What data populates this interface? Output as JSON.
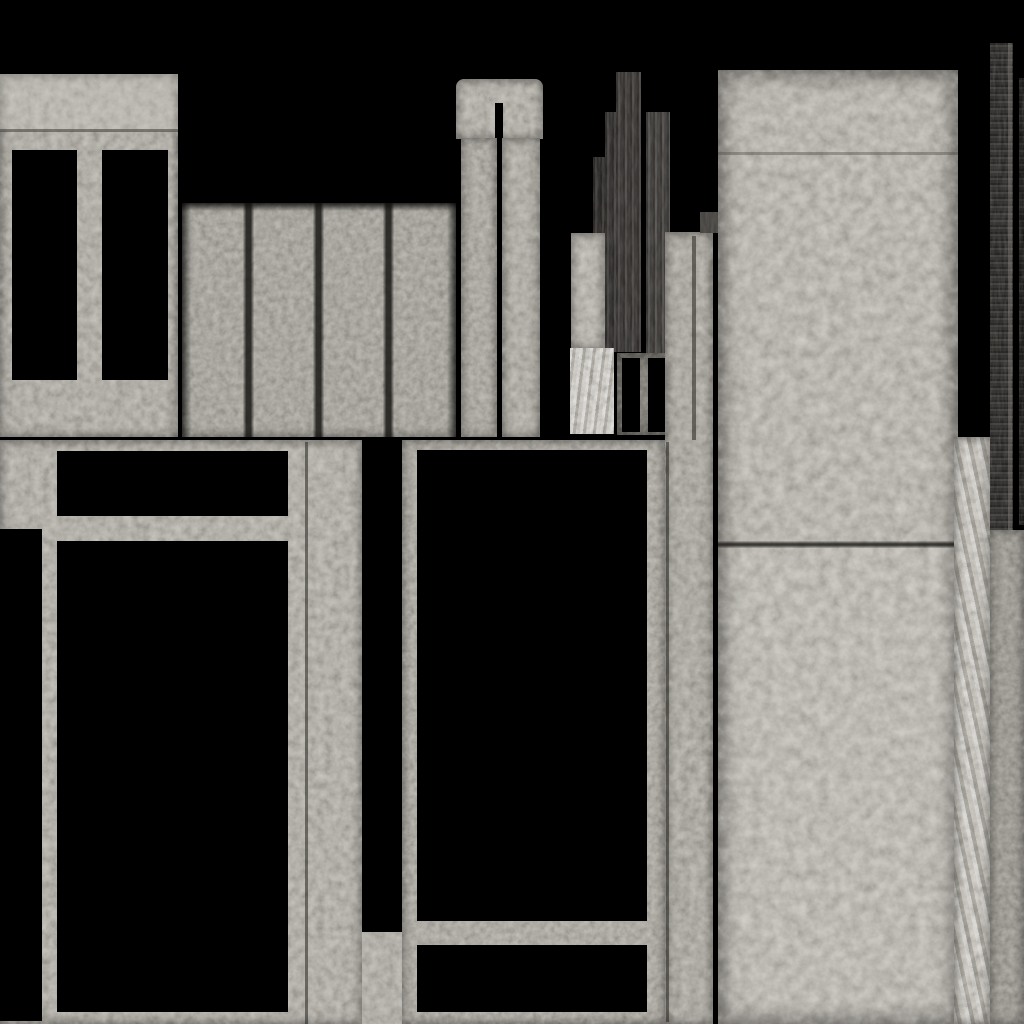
{
  "canvas": {
    "width": 1024,
    "height": 1024,
    "background": "#000000"
  },
  "palette": {
    "background": "#000000",
    "concrete_light": "#c1beb7",
    "concrete_mid": "#b5b2ab",
    "concrete_dark": "#8d8a83",
    "metal_dark": "#3e3c3a",
    "silver_streak": "#c5c2bb"
  },
  "shapes": [
    {
      "name": "top-left-panel",
      "cls": "concrete edge-soft",
      "x": 0,
      "y": 74,
      "w": 178,
      "h": 363,
      "fill": "#b9b6af"
    },
    {
      "name": "top-left-panel-upper-band",
      "cls": "plain",
      "x": 0,
      "y": 74,
      "w": 178,
      "h": 57,
      "fill": "rgba(210,207,200,0.30)"
    },
    {
      "name": "top-left-panel-seam",
      "cls": "plain",
      "x": 0,
      "y": 129,
      "w": 178,
      "h": 3,
      "fill": "rgba(60,58,53,0.55)"
    },
    {
      "name": "window-hole-a",
      "cls": "hole",
      "x": 12,
      "y": 150,
      "w": 65,
      "h": 230
    },
    {
      "name": "window-hole-b",
      "cls": "hole",
      "x": 102,
      "y": 150,
      "w": 66,
      "h": 230
    },
    {
      "name": "ribbed-panel",
      "cls": "concrete2 edge-soft",
      "x": 182,
      "y": 203,
      "w": 274,
      "h": 234,
      "fill": "#b2afa8"
    },
    {
      "name": "ribbed-panel-top-shadow",
      "cls": "fade-down",
      "x": 182,
      "y": 203,
      "w": 274,
      "h": 8
    },
    {
      "name": "rib-groove-1",
      "cls": "groove-v",
      "x": 243,
      "y": 203,
      "w": 11,
      "h": 234
    },
    {
      "name": "rib-groove-2",
      "cls": "groove-v",
      "x": 313,
      "y": 203,
      "w": 11,
      "h": 234
    },
    {
      "name": "rib-groove-3",
      "cls": "groove-v",
      "x": 383,
      "y": 203,
      "w": 11,
      "h": 234
    },
    {
      "name": "rib-edge-left",
      "cls": "fade-right",
      "x": 182,
      "y": 203,
      "w": 9,
      "h": 234
    },
    {
      "name": "rib-edge-right",
      "cls": "fade-left",
      "x": 447,
      "y": 203,
      "w": 9,
      "h": 234
    },
    {
      "name": "pillar-cap",
      "cls": "concrete edge-soft",
      "x": 456,
      "y": 79,
      "w": 87,
      "h": 60,
      "fill": "#bdbab3",
      "radius": "8px 8px 0 0"
    },
    {
      "name": "pillar-cap-notch",
      "cls": "hole",
      "x": 495,
      "y": 103,
      "w": 8,
      "h": 36
    },
    {
      "name": "pillar-leg-left",
      "cls": "concrete2 edge-soft",
      "x": 461,
      "y": 138,
      "w": 36,
      "h": 299,
      "fill": "#b7b4ad"
    },
    {
      "name": "pillar-leg-right",
      "cls": "concrete edge-soft",
      "x": 502,
      "y": 138,
      "w": 38,
      "h": 299,
      "fill": "#bab7b0"
    },
    {
      "name": "dark-bar-1",
      "cls": "metal streak-v",
      "x": 593,
      "y": 157,
      "w": 12,
      "h": 193,
      "fill": "#3b3936"
    },
    {
      "name": "dark-bar-2",
      "cls": "metal streak-v",
      "x": 605,
      "y": 112,
      "w": 11,
      "h": 240,
      "fill": "#454240"
    },
    {
      "name": "dark-bar-3",
      "cls": "metal streak-v",
      "x": 616,
      "y": 72,
      "w": 25,
      "h": 280,
      "fill": "#4d4a47"
    },
    {
      "name": "dark-bar-4",
      "cls": "metal streak-v",
      "x": 646,
      "y": 112,
      "w": 24,
      "h": 241,
      "fill": "#565350"
    },
    {
      "name": "light-block",
      "cls": "concrete edge-soft",
      "x": 571,
      "y": 233,
      "w": 34,
      "h": 116,
      "fill": "#c2bfb8"
    },
    {
      "name": "streaked-column",
      "cls": "streak-light",
      "x": 570,
      "y": 348,
      "w": 44,
      "h": 86,
      "fill": "#ccc9c2"
    },
    {
      "name": "door-frame",
      "cls": "concrete2 edge-strong",
      "x": 617,
      "y": 353,
      "w": 50,
      "h": 82,
      "fill": "#8d8a83"
    },
    {
      "name": "door-hole-left",
      "cls": "hole",
      "x": 622,
      "y": 358,
      "w": 18,
      "h": 74
    },
    {
      "name": "door-hole-right",
      "cls": "hole",
      "x": 648,
      "y": 358,
      "w": 17,
      "h": 74
    },
    {
      "name": "mid-column",
      "cls": "concrete edge-soft",
      "x": 665,
      "y": 232,
      "w": 48,
      "h": 792,
      "fill": "#b5b2ab"
    },
    {
      "name": "mid-column-dark-block",
      "cls": "metal",
      "x": 700,
      "y": 212,
      "w": 18,
      "h": 21,
      "fill": "#54514d"
    },
    {
      "name": "mid-column-seam-upper",
      "cls": "groove-thin",
      "x": 692,
      "y": 236,
      "w": 4,
      "h": 204
    },
    {
      "name": "mid-column-seam-lower",
      "cls": "groove-thin",
      "x": 666,
      "y": 442,
      "w": 3,
      "h": 580
    },
    {
      "name": "large-panel",
      "cls": "concrete3 edge-strong",
      "x": 718,
      "y": 70,
      "w": 240,
      "h": 954,
      "fill": "#c1beb7"
    },
    {
      "name": "large-panel-seam-faint",
      "cls": "plain",
      "x": 718,
      "y": 152,
      "w": 240,
      "h": 3,
      "fill": "rgba(75,73,67,0.40)"
    },
    {
      "name": "large-panel-seam",
      "cls": "groove-h",
      "x": 718,
      "y": 541,
      "w": 240,
      "h": 7
    },
    {
      "name": "large-panel-lower-sheen",
      "cls": "plain",
      "x": 718,
      "y": 548,
      "w": 240,
      "h": 476,
      "fill": "rgba(255,255,255,0.05)"
    },
    {
      "name": "right-dark-strip",
      "cls": "metal streak-h",
      "x": 990,
      "y": 43,
      "w": 23,
      "h": 494,
      "fill": "#3e3c3a"
    },
    {
      "name": "right-dark-strip-highlight",
      "cls": "plain",
      "x": 1008,
      "y": 43,
      "w": 4,
      "h": 494,
      "fill": "rgba(150,146,140,0.35)"
    },
    {
      "name": "right-edge-sliver",
      "cls": "metal streak-h",
      "x": 1019,
      "y": 78,
      "w": 5,
      "h": 447,
      "fill": "#232221"
    },
    {
      "name": "silver-column",
      "cls": "streak-diag edge-soft",
      "x": 954,
      "y": 437,
      "w": 36,
      "h": 587,
      "fill": "#c5c2bb"
    },
    {
      "name": "bottom-right-block",
      "cls": "concrete2 edge-soft",
      "x": 990,
      "y": 530,
      "w": 34,
      "h": 494,
      "fill": "#a7a49d"
    },
    {
      "name": "bottom-left-section",
      "cls": "concrete edge-soft",
      "x": 0,
      "y": 440,
      "w": 362,
      "h": 584,
      "fill": "#bbb8b1"
    },
    {
      "name": "bottom-left-gap-patch",
      "cls": "concrete",
      "x": 362,
      "y": 932,
      "w": 40,
      "h": 92,
      "fill": "#bbb8b1"
    },
    {
      "name": "bottom-left-seam",
      "cls": "groove-thin",
      "x": 305,
      "y": 442,
      "w": 3,
      "h": 582
    },
    {
      "name": "transom-hole",
      "cls": "hole",
      "x": 57,
      "y": 451,
      "w": 231,
      "h": 65
    },
    {
      "name": "main-window-hole",
      "cls": "hole",
      "x": 57,
      "y": 541,
      "w": 231,
      "h": 471
    },
    {
      "name": "left-notch-hole",
      "cls": "hole",
      "x": 0,
      "y": 529,
      "w": 42,
      "h": 492
    },
    {
      "name": "bottom-middle-section",
      "cls": "concrete2 edge-soft",
      "x": 402,
      "y": 440,
      "w": 263,
      "h": 584,
      "fill": "#b8b5ae"
    },
    {
      "name": "middle-window-upper-hole",
      "cls": "hole",
      "x": 417,
      "y": 450,
      "w": 230,
      "h": 471
    },
    {
      "name": "middle-window-lower-hole",
      "cls": "hole",
      "x": 417,
      "y": 945,
      "w": 230,
      "h": 67
    }
  ]
}
